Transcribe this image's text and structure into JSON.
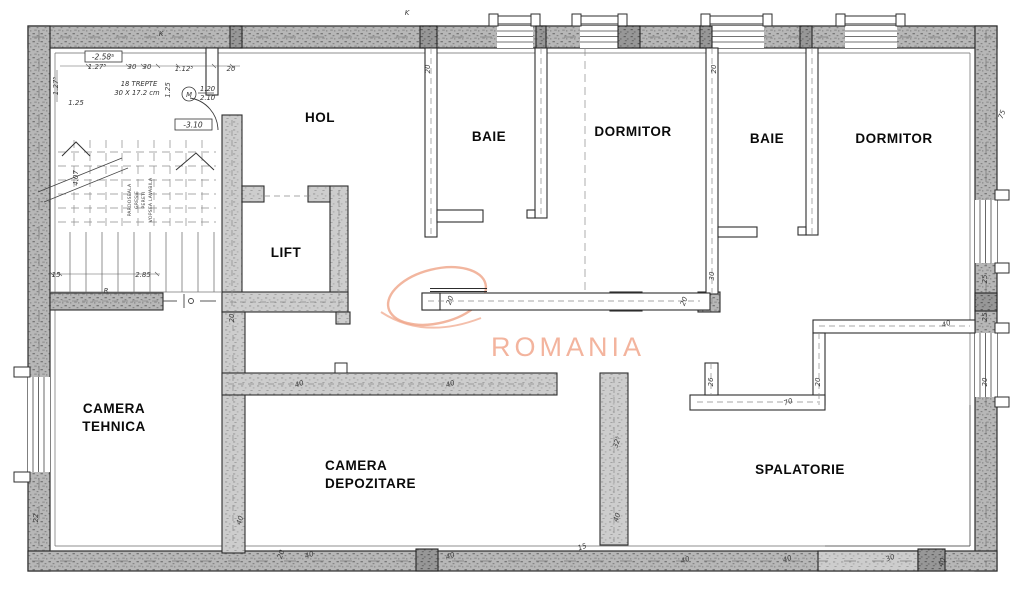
{
  "watermark": {
    "text": "ROMANIA",
    "accent_color": "#f0a488"
  },
  "rooms": {
    "hol": "HOL",
    "baie1": "BAIE",
    "dormitor1": "DORMITOR",
    "baie2": "BAIE",
    "dormitor2": "DORMITOR",
    "lift": "LIFT",
    "camera_tehnica_l1": "CAMERA",
    "camera_tehnica_l2": "TEHNICA",
    "camera_depozitare_l1": "CAMERA",
    "camera_depozitare_l2": "DEPOZITARE",
    "spalatorie": "SPALATORIE"
  },
  "stairs": {
    "level_upper": "-2.58⁵",
    "level_lower": "-3.10",
    "note1": "18 TREPTE",
    "note2": "30 X 17.2 cm",
    "door_mark": "M",
    "door_width": "1.20",
    "door_height": "2.10",
    "finish_note": [
      "PARDOSEALA",
      "GRESIE",
      "PERETI",
      "VOPSEA LAVABILA"
    ]
  },
  "dims": [
    "1.27⁵",
    "30",
    "30",
    "1.12⁵",
    "20",
    "1.25",
    "1.27⁵",
    "1.25",
    "4.07",
    "15",
    "2.85",
    "R",
    "K",
    "K",
    "20",
    "20",
    "20",
    "20",
    "20",
    "30",
    "25",
    "25",
    "20",
    "20",
    "26",
    "70",
    "32⁵",
    "40",
    "40",
    "40",
    "40",
    "20",
    "40",
    "40",
    "40",
    "40",
    "30",
    "40",
    "40",
    "75",
    "22",
    "15"
  ]
}
